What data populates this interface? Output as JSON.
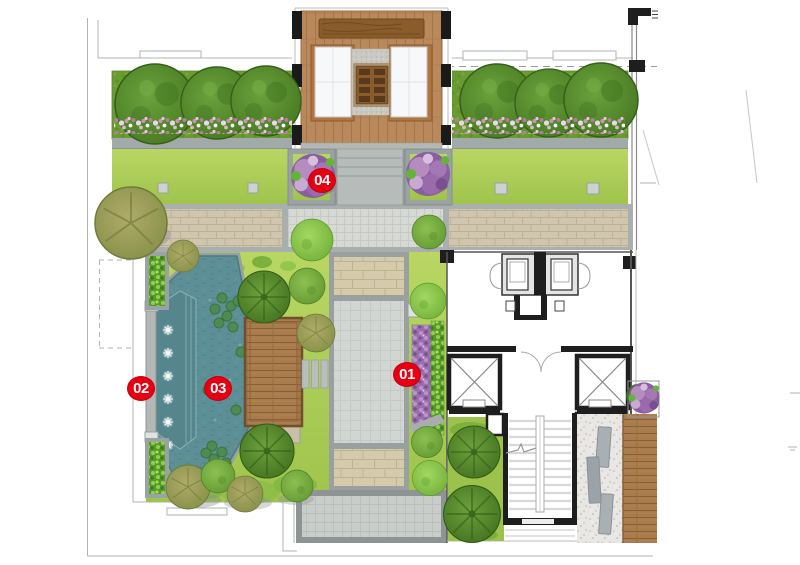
{
  "plan": {
    "markers": [
      {
        "label": "01"
      },
      {
        "label": "02"
      },
      {
        "label": "03"
      },
      {
        "label": "04"
      }
    ]
  },
  "colors": {
    "marker_red": "#e60012",
    "water_teal": "#5d8f96",
    "lawn_green": "#aed158",
    "planting_dark_green": "#6a9b31",
    "deck_wood_brown": "#a97c4e",
    "paving_tan": "#d0c6ae",
    "paving_gray": "#d2d6d3",
    "gravel_light": "#e8e7e3",
    "wall_black": "#1e1e1e",
    "flower_purple": "#9b6fae"
  }
}
